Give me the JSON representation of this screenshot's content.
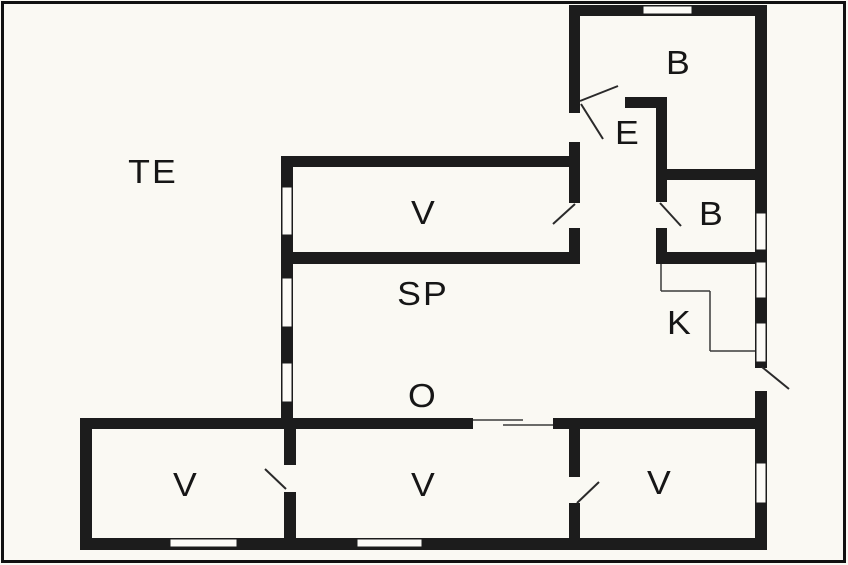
{
  "plan": {
    "type": "floor-plan",
    "canvas": {
      "width": 848,
      "height": 565
    },
    "colors": {
      "background": "#faf9f3",
      "wall": "#1c1c1c",
      "frame": "#111111",
      "door_line": "#2a2a2a",
      "thin_line": "#3a3a3a",
      "window_fill": "#fcfbf7",
      "label": "#161616"
    },
    "frame": {
      "x": 1,
      "y": 1,
      "w": 845,
      "h": 562,
      "stroke_width": 3
    },
    "rooms": [
      {
        "id": "terrace",
        "label": "TE",
        "cx": 153,
        "cy": 172
      },
      {
        "id": "room-v-top",
        "label": "V",
        "cx": 424,
        "cy": 213
      },
      {
        "id": "room-sp",
        "label": "SP",
        "cx": 423,
        "cy": 294
      },
      {
        "id": "hall-o",
        "label": "O",
        "cx": 423,
        "cy": 396
      },
      {
        "id": "room-b-top",
        "label": "B",
        "cx": 679,
        "cy": 63
      },
      {
        "id": "entry-e",
        "label": "E",
        "cx": 628,
        "cy": 133
      },
      {
        "id": "room-b-bottom",
        "label": "B",
        "cx": 712,
        "cy": 214
      },
      {
        "id": "kitchen-k",
        "label": "K",
        "cx": 680,
        "cy": 323
      },
      {
        "id": "room-v-left",
        "label": "V",
        "cx": 186,
        "cy": 485
      },
      {
        "id": "room-v-middle",
        "label": "V",
        "cx": 424,
        "cy": 485
      },
      {
        "id": "room-v-right",
        "label": "V",
        "cx": 660,
        "cy": 483
      }
    ],
    "walls": [
      {
        "name": "top-wall",
        "x": 569,
        "y": 5,
        "w": 198,
        "h": 11
      },
      {
        "name": "right-wall",
        "x": 755,
        "y": 5,
        "w": 12,
        "h": 545
      },
      {
        "name": "entry-column-left-wall",
        "x": 569,
        "y": 5,
        "w": 11,
        "h": 259
      },
      {
        "name": "v-top-room-top-wall",
        "x": 281,
        "y": 156,
        "w": 299,
        "h": 11
      },
      {
        "name": "house-left-wall",
        "x": 281,
        "y": 156,
        "w": 12,
        "h": 273
      },
      {
        "name": "v-top-room-bottom-wall",
        "x": 281,
        "y": 252,
        "w": 299,
        "h": 12
      },
      {
        "name": "entry-top-wall",
        "x": 625,
        "y": 97,
        "w": 42,
        "h": 11
      },
      {
        "name": "corridor-right-wall",
        "x": 656,
        "y": 97,
        "w": 11,
        "h": 167
      },
      {
        "name": "b-rooms-divider-wall",
        "x": 656,
        "y": 169,
        "w": 111,
        "h": 11
      },
      {
        "name": "b-bottom-room-bottom-wall",
        "x": 656,
        "y": 252,
        "w": 111,
        "h": 12
      },
      {
        "name": "bottom-row-top-wall-left",
        "x": 80,
        "y": 418,
        "w": 393,
        "h": 11
      },
      {
        "name": "bottom-row-top-wall-right",
        "x": 553,
        "y": 418,
        "w": 214,
        "h": 11
      },
      {
        "name": "bottom-left-room-left-wall",
        "x": 80,
        "y": 418,
        "w": 12,
        "h": 132
      },
      {
        "name": "bottom-wall",
        "x": 80,
        "y": 538,
        "w": 687,
        "h": 12
      },
      {
        "name": "divider-left-middle",
        "x": 284,
        "y": 418,
        "w": 12,
        "h": 132
      },
      {
        "name": "divider-middle-right",
        "x": 569,
        "y": 429,
        "w": 11,
        "h": 121
      }
    ],
    "door_openings": [
      {
        "name": "entry-exterior-door-gap",
        "x": 569,
        "y": 113,
        "w": 11,
        "h": 29
      },
      {
        "name": "v-top-room-door-gap",
        "x": 569,
        "y": 203,
        "w": 11,
        "h": 25
      },
      {
        "name": "b-bottom-room-door-gap",
        "x": 656,
        "y": 202,
        "w": 11,
        "h": 26
      },
      {
        "name": "kitchen-exterior-door-gap",
        "x": 755,
        "y": 368,
        "w": 12,
        "h": 23
      },
      {
        "name": "left-room-door-gap",
        "x": 284,
        "y": 465,
        "w": 12,
        "h": 27
      },
      {
        "name": "right-room-door-gap",
        "x": 569,
        "y": 477,
        "w": 11,
        "h": 26
      }
    ],
    "windows": [
      {
        "name": "top-wall-window",
        "x": 643,
        "y": 6,
        "w": 49,
        "h": 8
      },
      {
        "name": "right-wall-window-1",
        "x": 756,
        "y": 213,
        "w": 10,
        "h": 37
      },
      {
        "name": "right-wall-window-2",
        "x": 756,
        "y": 262,
        "w": 10,
        "h": 36
      },
      {
        "name": "right-wall-window-3",
        "x": 756,
        "y": 323,
        "w": 10,
        "h": 39
      },
      {
        "name": "right-wall-window-4",
        "x": 756,
        "y": 463,
        "w": 10,
        "h": 40
      },
      {
        "name": "left-wall-window-1",
        "x": 282,
        "y": 187,
        "w": 10,
        "h": 48
      },
      {
        "name": "left-wall-window-2",
        "x": 282,
        "y": 278,
        "w": 10,
        "h": 49
      },
      {
        "name": "left-wall-window-3",
        "x": 282,
        "y": 363,
        "w": 10,
        "h": 39
      },
      {
        "name": "bottom-wall-window-1",
        "x": 170,
        "y": 539,
        "w": 67,
        "h": 8
      },
      {
        "name": "bottom-wall-window-2",
        "x": 357,
        "y": 539,
        "w": 65,
        "h": 8
      }
    ],
    "door_swings": [
      {
        "name": "entry-door-swing-a",
        "x1": 580,
        "y1": 101,
        "x2": 618,
        "y2": 86
      },
      {
        "name": "entry-door-swing-b",
        "x1": 581,
        "y1": 104,
        "x2": 603,
        "y2": 139
      },
      {
        "name": "v-top-room-door-swing",
        "x1": 553,
        "y1": 224,
        "x2": 575,
        "y2": 204
      },
      {
        "name": "b-bottom-room-door-swing",
        "x1": 660,
        "y1": 203,
        "x2": 681,
        "y2": 226
      },
      {
        "name": "kitchen-exterior-door-swing",
        "x1": 762,
        "y1": 367,
        "x2": 789,
        "y2": 389
      },
      {
        "name": "left-room-door-swing",
        "x1": 265,
        "y1": 469,
        "x2": 286,
        "y2": 489
      },
      {
        "name": "right-room-door-swing",
        "x1": 577,
        "y1": 503,
        "x2": 599,
        "y2": 482
      }
    ],
    "thin_lines": [
      {
        "name": "kitchen-boundary-1",
        "x1": 661,
        "y1": 264,
        "x2": 661,
        "y2": 291
      },
      {
        "name": "kitchen-boundary-2",
        "x1": 661,
        "y1": 291,
        "x2": 710,
        "y2": 291
      },
      {
        "name": "kitchen-boundary-3",
        "x1": 710,
        "y1": 291,
        "x2": 710,
        "y2": 351
      },
      {
        "name": "kitchen-boundary-4",
        "x1": 710,
        "y1": 351,
        "x2": 755,
        "y2": 351
      },
      {
        "name": "sliding-opening-line-1",
        "x1": 473,
        "y1": 420,
        "x2": 523,
        "y2": 420
      },
      {
        "name": "sliding-opening-line-2",
        "x1": 503,
        "y1": 425,
        "x2": 553,
        "y2": 425
      }
    ]
  }
}
